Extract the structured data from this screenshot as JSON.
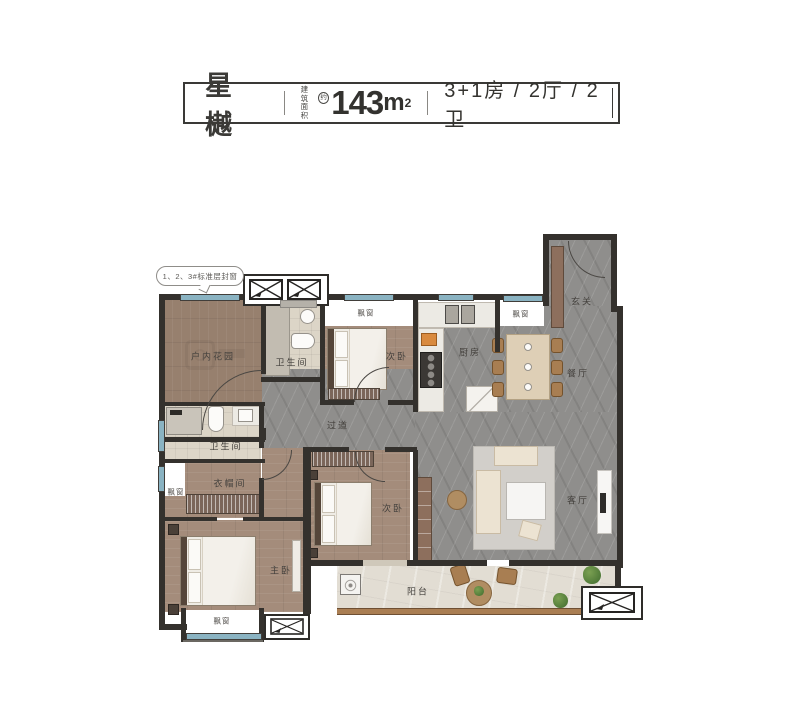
{
  "header": {
    "title": "星樾",
    "area_prefix_line1": "建筑",
    "area_prefix_line2": "面积",
    "area_approx": "约",
    "area_value": "143",
    "area_unit": "m",
    "area_sup": "2",
    "unit_spec": "3+1房 / 2厅 / 2卫"
  },
  "callout": "1、2、3#标准层封窗",
  "rooms": {
    "indoor_garden": "户内花园",
    "bathroom": "卫生间",
    "secondary_bedroom": "次卧",
    "kitchen": "厨房",
    "foyer": "玄关",
    "dining_room": "餐厅",
    "living_room": "客厅",
    "hallway": "过道",
    "cloakroom": "衣帽间",
    "master_bedroom": "主卧",
    "balcony": "阳台",
    "bay_window": "飘窗"
  },
  "colors": {
    "wall": "#34312d",
    "window_glass": "#8ab3c2",
    "wood_floor": "#a48c7b",
    "marble_floor": "#8f8e8c",
    "balcony_rail": "#aa7e53"
  }
}
